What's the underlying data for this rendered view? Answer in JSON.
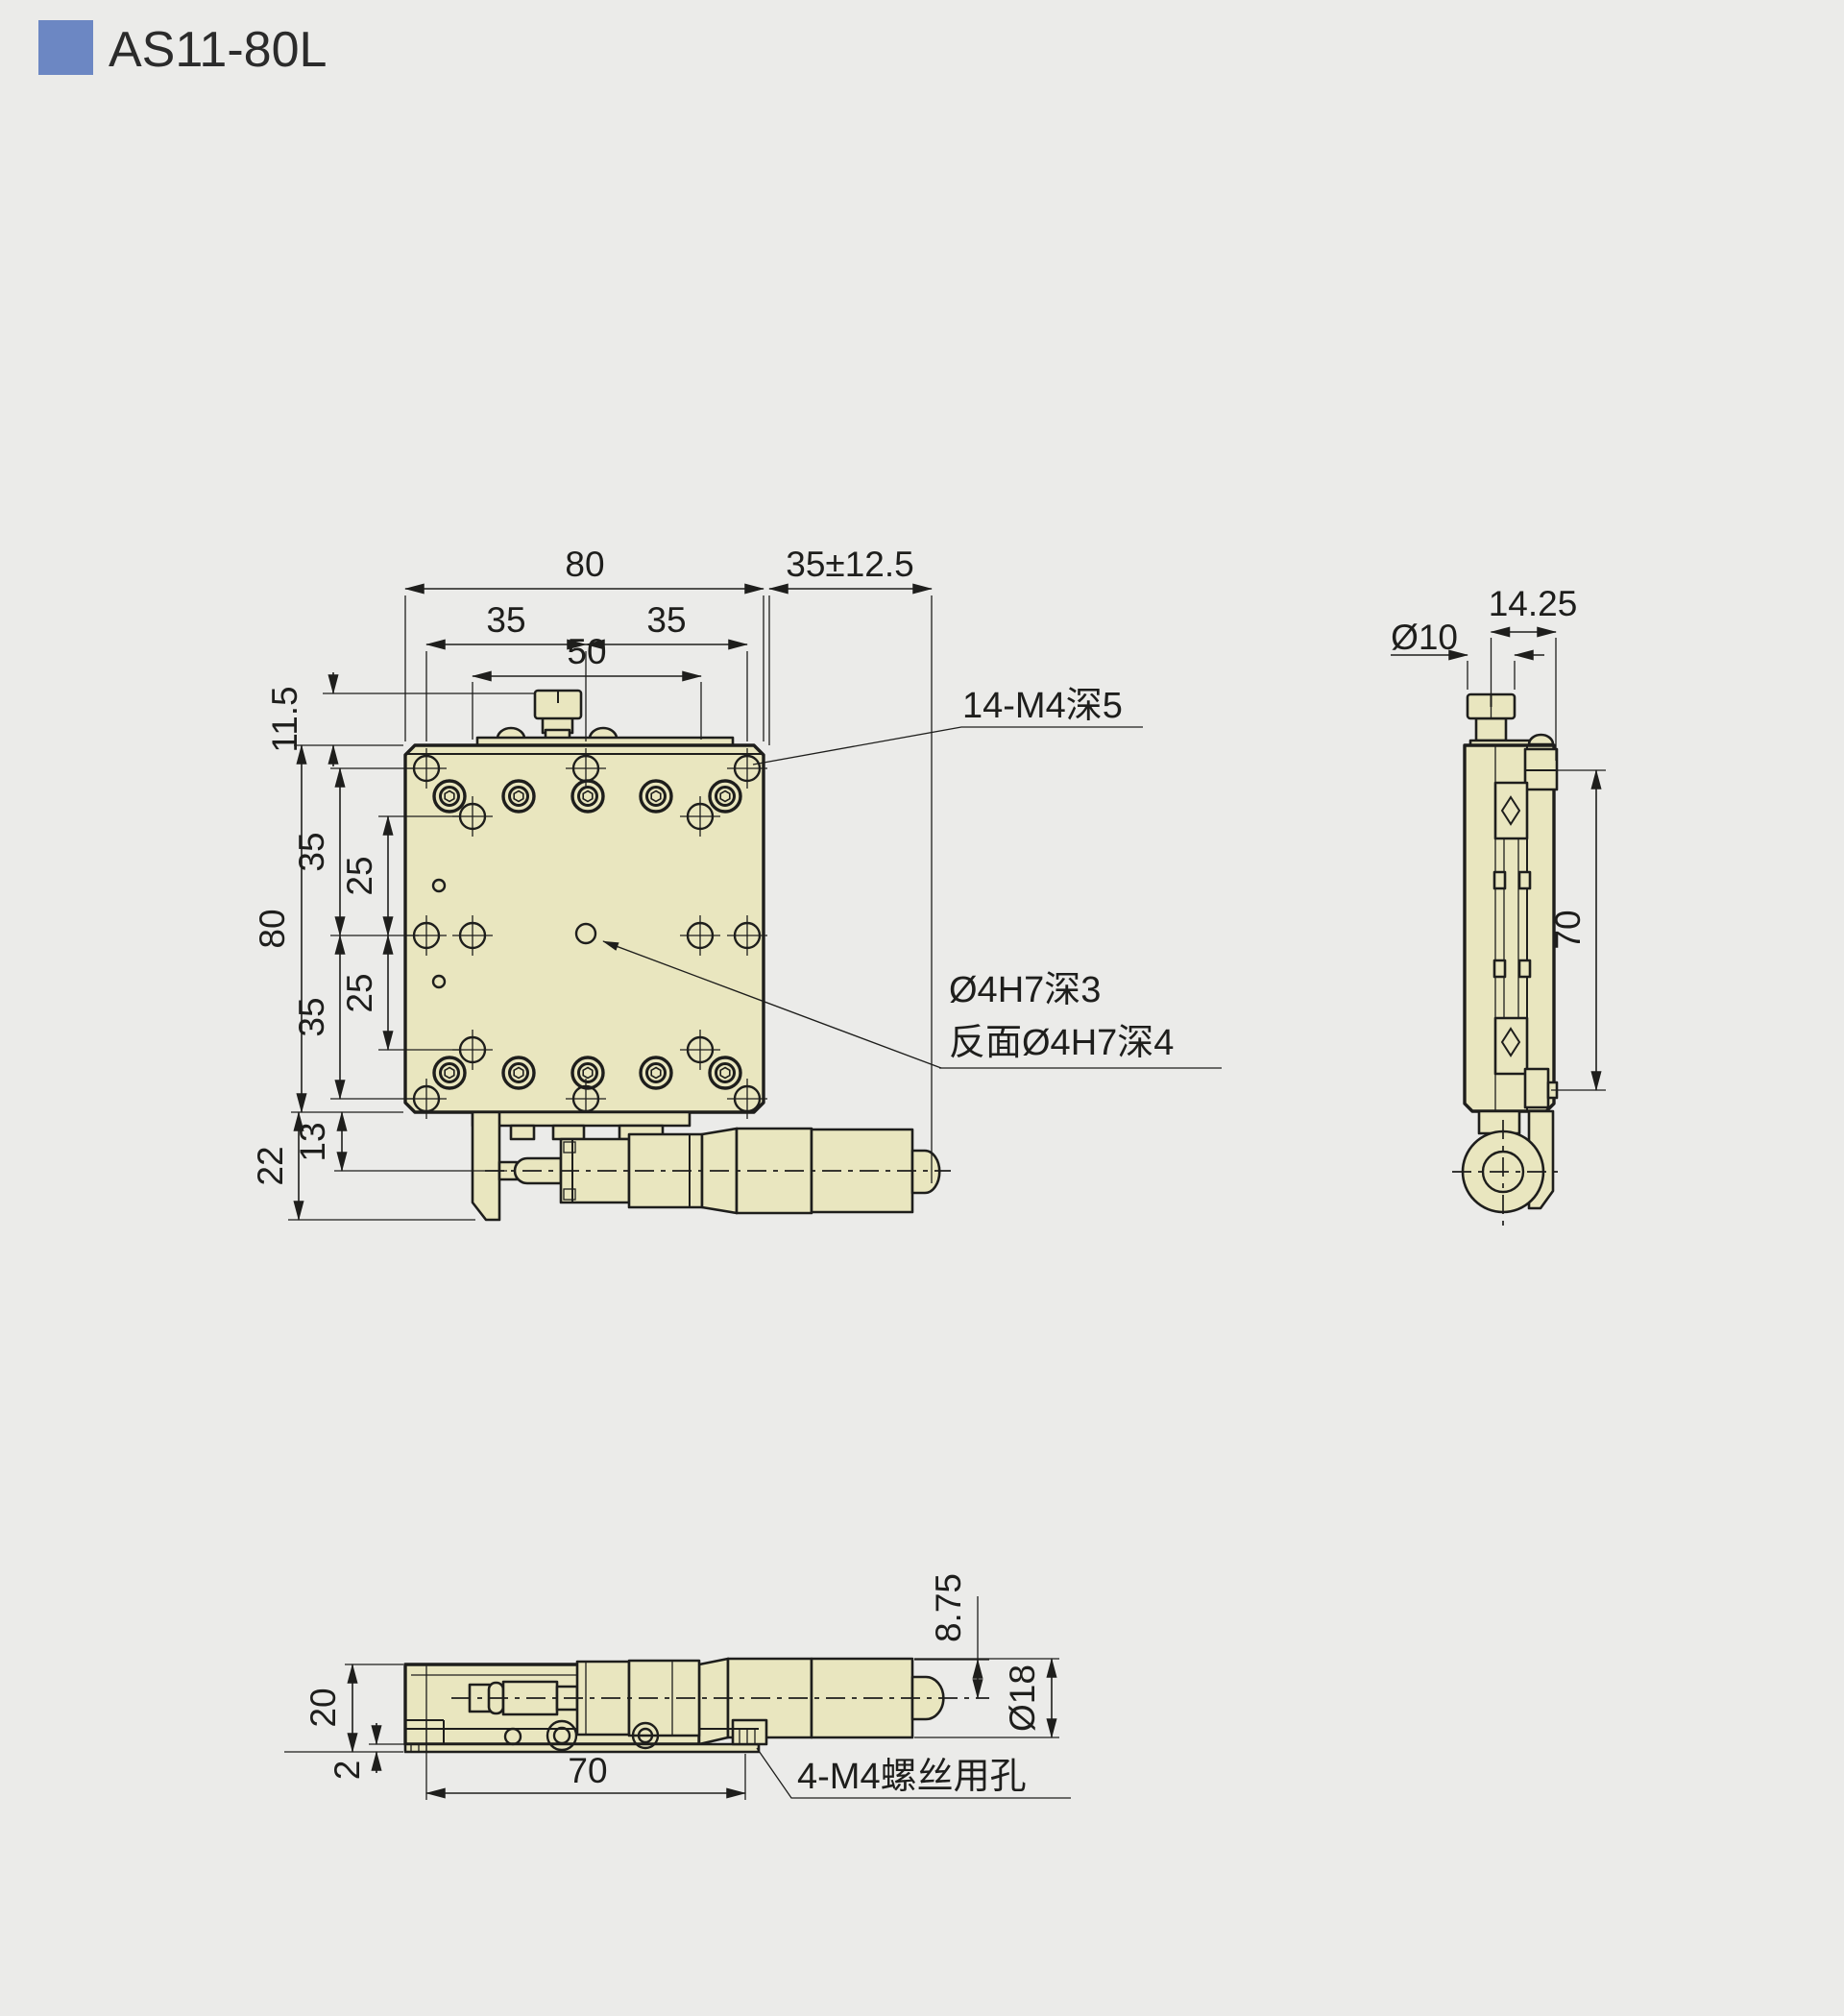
{
  "colors": {
    "background": "#ebebe9",
    "accent": "#6c87c3",
    "part_fill": "#e9e6bf",
    "line": "#1e1e1c"
  },
  "header": {
    "title": "AS11-80L"
  },
  "front_view": {
    "dim_width_top": "80",
    "dim_travel": "35±12.5",
    "dim_hole_pitch_left": "35",
    "dim_hole_pitch_right": "35",
    "dim_hole_pitch_50": "50",
    "dim_knob_height": "11.5",
    "dim_pitch_upper_35": "35",
    "dim_pitch_upper_25": "25",
    "dim_height_left": "80",
    "dim_pitch_lower_25": "25",
    "dim_pitch_lower_35": "35",
    "dim_base_height": "22",
    "dim_axis_height": "13",
    "note_tapped_holes": "14-M4深5",
    "note_pin_hole_line1": "Ø4H7深3",
    "note_pin_hole_line2": "反面Ø4H7深4"
  },
  "side_view": {
    "dim_knob_dia": "Ø10",
    "dim_knob_offset": "14.25",
    "dim_length": "70"
  },
  "bottom_view": {
    "dim_height": "20",
    "dim_plate_thickness": "2",
    "dim_length": "70",
    "dim_axis_offset": "8.75",
    "dim_knob_dia": "Ø18",
    "note_screw_holes": "4-M4螺丝用孔"
  }
}
